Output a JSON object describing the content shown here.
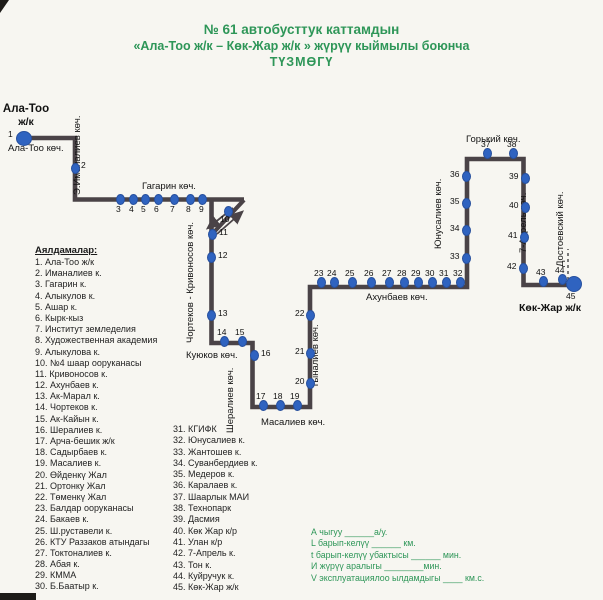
{
  "title": {
    "line1": "№ 61 автобусттук каттамдын",
    "line2": "«Ала-Тоо ж/к – Көк-Жар ж/к » жүрүү кыймылы боюнча",
    "line3": "ТҮЗМӨГҮ"
  },
  "colors": {
    "title_green": "#2e9658",
    "legend_green": "#2e9658",
    "route_line": "#4a4347",
    "stop_blue": "#2f63c0",
    "paper": "#f7f6f1"
  },
  "terminals": {
    "start": {
      "name": "Ала-Тоо",
      "type": "ж/к",
      "stop_number": "1"
    },
    "end": {
      "name": "Көк-Жар ж/к",
      "stop_number": "45"
    }
  },
  "map": {
    "street_labels": [
      {
        "text": "Ала-Тоо көч.",
        "x": 8,
        "y": 143,
        "rot": false
      },
      {
        "text": "Э.Иманалиев көч.",
        "x": 83,
        "y": 195,
        "rot": true
      },
      {
        "text": "Гагарин көч.",
        "x": 142,
        "y": 181,
        "rot": false
      },
      {
        "text": "Чортеков - Кривоносов көч.",
        "x": 196,
        "y": 343,
        "rot": true
      },
      {
        "text": "Куюков көч.",
        "x": 186,
        "y": 350,
        "rot": false
      },
      {
        "text": "Шералиев көч.",
        "x": 236,
        "y": 433,
        "rot": true
      },
      {
        "text": "Масалиев көч.",
        "x": 261,
        "y": 417,
        "rot": false
      },
      {
        "text": "Тыналиев көч.",
        "x": 321,
        "y": 388,
        "rot": true
      },
      {
        "text": "Ахунбаев көч.",
        "x": 366,
        "y": 292,
        "rot": false
      },
      {
        "text": "Юнусалиев көч.",
        "x": 444,
        "y": 249,
        "rot": true
      },
      {
        "text": "Горький көч.",
        "x": 466,
        "y": 134,
        "rot": false
      },
      {
        "text": "7-Апрель көч.",
        "x": 529,
        "y": 253,
        "rot": true
      },
      {
        "text": "Достоевский көч.",
        "x": 566,
        "y": 267,
        "rot": true
      }
    ],
    "stops": [
      {
        "n": "1",
        "x": 24,
        "y": 138,
        "lx": 8,
        "ly": 130,
        "terminal": true
      },
      {
        "n": "2",
        "x": 75,
        "y": 168,
        "lx": 81,
        "ly": 161
      },
      {
        "n": "3",
        "x": 120,
        "y": 199,
        "lx": 116,
        "ly": 205
      },
      {
        "n": "4",
        "x": 133,
        "y": 199,
        "lx": 129,
        "ly": 205
      },
      {
        "n": "5",
        "x": 145,
        "y": 199,
        "lx": 141,
        "ly": 205
      },
      {
        "n": "6",
        "x": 158,
        "y": 199,
        "lx": 154,
        "ly": 205
      },
      {
        "n": "7",
        "x": 174,
        "y": 199,
        "lx": 170,
        "ly": 205
      },
      {
        "n": "8",
        "x": 190,
        "y": 199,
        "lx": 186,
        "ly": 205
      },
      {
        "n": "9",
        "x": 202,
        "y": 199,
        "lx": 199,
        "ly": 205
      },
      {
        "n": "10",
        "x": 228,
        "y": 211,
        "lx": 220,
        "ly": 215
      },
      {
        "n": "11",
        "x": 212,
        "y": 234,
        "lx": 219,
        "ly": 228
      },
      {
        "n": "12",
        "x": 211,
        "y": 257,
        "lx": 218,
        "ly": 251
      },
      {
        "n": "13",
        "x": 211,
        "y": 315,
        "lx": 218,
        "ly": 309
      },
      {
        "n": "14",
        "x": 224,
        "y": 341,
        "lx": 217,
        "ly": 328
      },
      {
        "n": "15",
        "x": 242,
        "y": 341,
        "lx": 235,
        "ly": 328
      },
      {
        "n": "16",
        "x": 254,
        "y": 355,
        "lx": 261,
        "ly": 349
      },
      {
        "n": "17",
        "x": 263,
        "y": 405,
        "lx": 256,
        "ly": 392
      },
      {
        "n": "18",
        "x": 280,
        "y": 405,
        "lx": 273,
        "ly": 392
      },
      {
        "n": "19",
        "x": 297,
        "y": 405,
        "lx": 290,
        "ly": 392
      },
      {
        "n": "20",
        "x": 310,
        "y": 383,
        "lx": 295,
        "ly": 377
      },
      {
        "n": "21",
        "x": 310,
        "y": 353,
        "lx": 295,
        "ly": 347
      },
      {
        "n": "22",
        "x": 310,
        "y": 315,
        "lx": 295,
        "ly": 309
      },
      {
        "n": "23",
        "x": 321,
        "y": 282,
        "lx": 314,
        "ly": 269
      },
      {
        "n": "24",
        "x": 334,
        "y": 282,
        "lx": 327,
        "ly": 269
      },
      {
        "n": "25",
        "x": 352,
        "y": 282,
        "lx": 345,
        "ly": 269
      },
      {
        "n": "26",
        "x": 371,
        "y": 282,
        "lx": 364,
        "ly": 269
      },
      {
        "n": "27",
        "x": 389,
        "y": 282,
        "lx": 382,
        "ly": 269
      },
      {
        "n": "28",
        "x": 404,
        "y": 282,
        "lx": 397,
        "ly": 269
      },
      {
        "n": "29",
        "x": 418,
        "y": 282,
        "lx": 411,
        "ly": 269
      },
      {
        "n": "30",
        "x": 432,
        "y": 282,
        "lx": 425,
        "ly": 269
      },
      {
        "n": "31",
        "x": 446,
        "y": 282,
        "lx": 439,
        "ly": 269
      },
      {
        "n": "32",
        "x": 460,
        "y": 282,
        "lx": 453,
        "ly": 269
      },
      {
        "n": "33",
        "x": 466,
        "y": 258,
        "lx": 450,
        "ly": 252
      },
      {
        "n": "34",
        "x": 466,
        "y": 230,
        "lx": 450,
        "ly": 224
      },
      {
        "n": "35",
        "x": 466,
        "y": 203,
        "lx": 450,
        "ly": 197
      },
      {
        "n": "36",
        "x": 466,
        "y": 176,
        "lx": 450,
        "ly": 170
      },
      {
        "n": "37",
        "x": 487,
        "y": 153,
        "lx": 481,
        "ly": 140
      },
      {
        "n": "38",
        "x": 513,
        "y": 153,
        "lx": 507,
        "ly": 140
      },
      {
        "n": "39",
        "x": 525,
        "y": 178,
        "lx": 509,
        "ly": 172
      },
      {
        "n": "40",
        "x": 525,
        "y": 207,
        "lx": 509,
        "ly": 201
      },
      {
        "n": "41",
        "x": 524,
        "y": 237,
        "lx": 508,
        "ly": 231
      },
      {
        "n": "42",
        "x": 523,
        "y": 268,
        "lx": 507,
        "ly": 262
      },
      {
        "n": "43",
        "x": 543,
        "y": 281,
        "lx": 536,
        "ly": 268
      },
      {
        "n": "44",
        "x": 562,
        "y": 279,
        "lx": 555,
        "ly": 266
      },
      {
        "n": "45",
        "x": 574,
        "y": 284,
        "lx": 566,
        "ly": 292,
        "terminal": true
      }
    ]
  },
  "stop_list": {
    "header": "Аялдамалар:",
    "column1": [
      "1. Ала-Тоо ж/к",
      "2. Иманалиев к.",
      "3. Гагарин к.",
      "4. Алыкулов к.",
      "5. Ашар к.",
      "6. Кырк-кыз",
      "7. Институт земледелия",
      "8. Художественная академия",
      "9. Алыкулова к.",
      "10. №4 шаар ооруканасы",
      "11. Кривоносов к.",
      "12. Ахунбаев к.",
      "13. Ак-Марал к.",
      "14. Чортеков к.",
      "15. Ак-Кайын к.",
      "16. Шералиев к.",
      "17. Арча-бешик ж/к",
      "18. Садырбаев к.",
      "19. Масалиев к.",
      "20. Өйденкү Жал",
      "21. Ортонку Жал",
      "22. Төменкү Жал",
      "23. Балдар ооруканасы",
      "24. Бакаев к.",
      "25. Ш.руставели к.",
      "26. КТУ Раззаков атындагы",
      "27. Токтоналиев к.",
      "28. Абая к.",
      "29. КММА",
      "30. Б.Баатыр к."
    ],
    "column2": [
      "31. КГИФК",
      "32. Юнусалиев к.",
      "33. Жантошев к.",
      "34. Суванбердиев к.",
      "35. Медеров к.",
      "36. Каралаев к.",
      "37. Шаарлык МАИ",
      "38. Технопарк",
      "39. Дасмия",
      "40. Көк Жар к/р",
      "41. Улан к/р",
      "42. 7-Апрель к.",
      "43. Тон к.",
      "44. Куйручук к.",
      "45. Көк-Жар ж/к"
    ]
  },
  "legend": [
    "А чыгуу ______а/у.",
    "L барып-келүү ______ км.",
    "t барып-келүү убактысы ______ мин.",
    "И жүрүү аралыгы ________мин.",
    "V эксплуатациялоо ылдамдыгы ____ км.с."
  ]
}
